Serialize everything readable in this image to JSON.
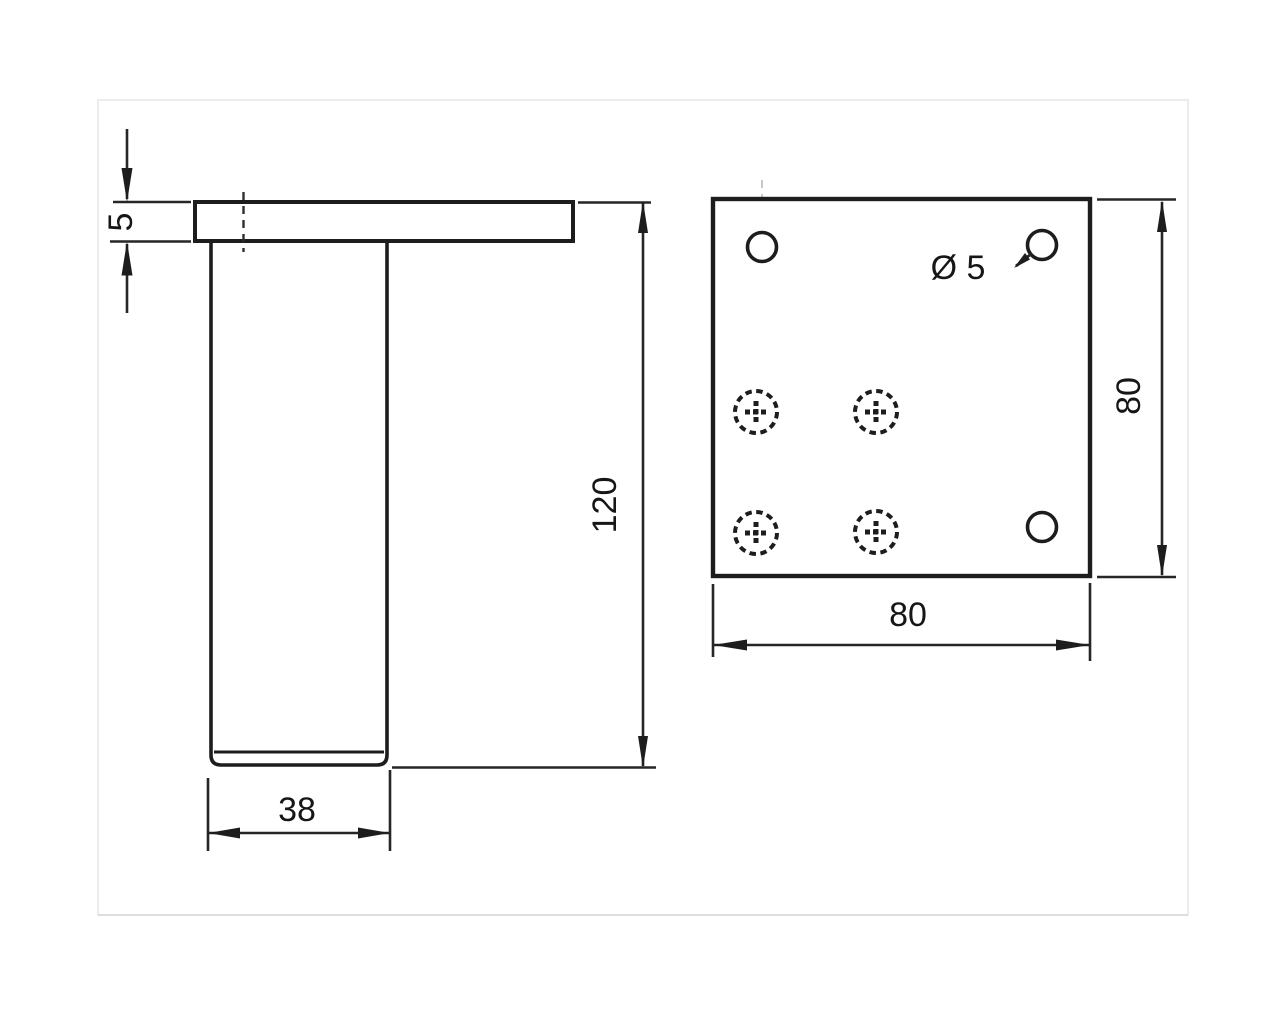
{
  "drawing_title": "furniture-leg-technical-drawing",
  "colors": {
    "line": "#1d1d1d",
    "dimension": "#262626",
    "centerline": "#2f2f2f",
    "faint_centerline": "#c9c9c9",
    "scan_frame": "#e7e7e7",
    "background": "#ffffff"
  },
  "side_view": {
    "name": "leg side view",
    "dimensions": {
      "plate_thickness": "5",
      "leg_height": "120",
      "leg_diameter": "38"
    }
  },
  "top_view": {
    "name": "mounting plate top view",
    "dimensions": {
      "hole_diameter": "Ø 5",
      "plate_height": "80",
      "plate_width": "80"
    },
    "hole_count": 3,
    "screw_count": 4
  }
}
